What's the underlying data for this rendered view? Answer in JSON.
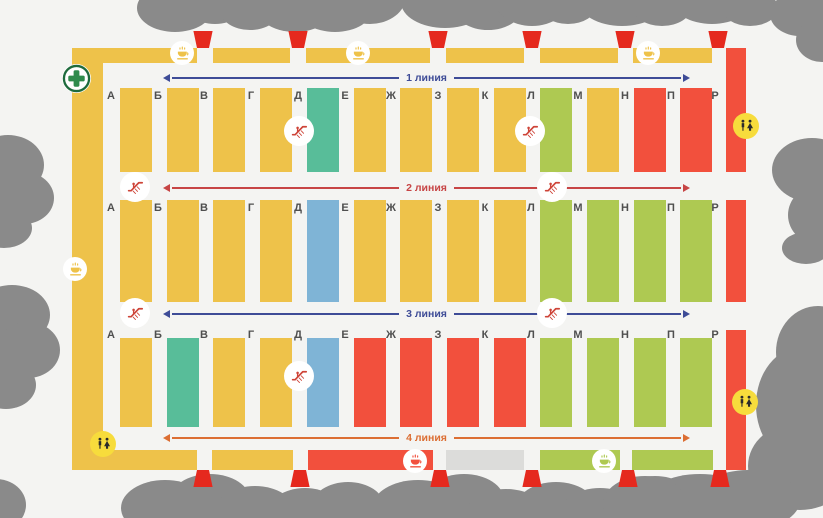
{
  "colors": {
    "background": "#F4F4F2",
    "yellow": "#EEC24A",
    "teal": "#58BD99",
    "blue": "#7FB4D6",
    "green": "#AEC952",
    "red": "#F2503D",
    "gray": "#DCDCDA",
    "trees_gray": "#8A8A8A",
    "entrance_red": "#E5291E",
    "wc_badge_yellow": "#F7DC3C",
    "icon_dark": "#2B2B2B",
    "escalator_red": "#CE4438",
    "first_aid_green": "#2F8B4C",
    "first_aid_ring": "#1E6B3D",
    "letter_gray": "#4F4F4F",
    "line_blue": "#3E4C97",
    "line_red": "#C74545",
    "line_orange": "#DC6E33"
  },
  "lines": [
    {
      "label": "1 линия",
      "color": "line_blue"
    },
    {
      "label": "2 линия",
      "color": "line_red"
    },
    {
      "label": "3 линия",
      "color": "line_blue"
    },
    {
      "label": "4 линия",
      "color": "line_orange"
    }
  ],
  "rows": [
    {
      "id": "row-1",
      "cells": [
        {
          "letter": "А",
          "color": "yellow"
        },
        {
          "letter": "Б",
          "color": "yellow"
        },
        {
          "letter": "В",
          "color": "yellow"
        },
        {
          "letter": "Г",
          "color": "yellow"
        },
        {
          "letter": "Д",
          "color": "teal"
        },
        {
          "letter": "Е",
          "color": "yellow"
        },
        {
          "letter": "Ж",
          "color": "yellow"
        },
        {
          "letter": "З",
          "color": "yellow"
        },
        {
          "letter": "К",
          "color": "yellow"
        },
        {
          "letter": "Л",
          "color": "green"
        },
        {
          "letter": "М",
          "color": "yellow"
        },
        {
          "letter": "Н",
          "color": "red"
        },
        {
          "letter": "П",
          "color": "red"
        }
      ]
    },
    {
      "id": "row-2",
      "cells": [
        {
          "letter": "А",
          "color": "yellow"
        },
        {
          "letter": "Б",
          "color": "yellow"
        },
        {
          "letter": "В",
          "color": "yellow"
        },
        {
          "letter": "Г",
          "color": "yellow"
        },
        {
          "letter": "Д",
          "color": "blue"
        },
        {
          "letter": "Е",
          "color": "yellow"
        },
        {
          "letter": "Ж",
          "color": "yellow"
        },
        {
          "letter": "З",
          "color": "yellow"
        },
        {
          "letter": "К",
          "color": "yellow"
        },
        {
          "letter": "Л",
          "color": "green"
        },
        {
          "letter": "М",
          "color": "green"
        },
        {
          "letter": "Н",
          "color": "green"
        },
        {
          "letter": "П",
          "color": "green"
        }
      ]
    },
    {
      "id": "row-3",
      "cells": [
        {
          "letter": "А",
          "color": "yellow"
        },
        {
          "letter": "Б",
          "color": "teal"
        },
        {
          "letter": "В",
          "color": "yellow"
        },
        {
          "letter": "Г",
          "color": "yellow"
        },
        {
          "letter": "Д",
          "color": "blue"
        },
        {
          "letter": "Е",
          "color": "red"
        },
        {
          "letter": "Ж",
          "color": "red"
        },
        {
          "letter": "З",
          "color": "red"
        },
        {
          "letter": "К",
          "color": "red"
        },
        {
          "letter": "Л",
          "color": "green"
        },
        {
          "letter": "М",
          "color": "green"
        },
        {
          "letter": "Н",
          "color": "green"
        },
        {
          "letter": "П",
          "color": "green"
        }
      ]
    }
  ],
  "right_band": {
    "letter": "Р",
    "segments": [
      {
        "color": "red"
      },
      {
        "color": "red"
      },
      {
        "color": "red"
      }
    ]
  },
  "left_band": {
    "color": "yellow"
  },
  "top_band": {
    "segments": [
      {
        "color": "yellow"
      },
      {
        "color": "yellow"
      },
      {
        "color": "yellow"
      },
      {
        "color": "yellow"
      },
      {
        "color": "yellow"
      },
      {
        "color": "yellow"
      }
    ]
  },
  "bottom_band": {
    "segments": [
      {
        "color": "yellow"
      },
      {
        "color": "yellow"
      },
      {
        "color": "red"
      },
      {
        "color": "gray"
      },
      {
        "color": "green"
      },
      {
        "color": "green"
      }
    ]
  },
  "icons": {
    "first-aid-icon": "green cross in white ring",
    "coffee-icon": "steaming cup on saucer",
    "escalator-icon": "person on escalator",
    "wc-icon": "man and woman figures",
    "entrance-marker": "red gate trapezoid",
    "trees": "gray canopy blobs"
  }
}
